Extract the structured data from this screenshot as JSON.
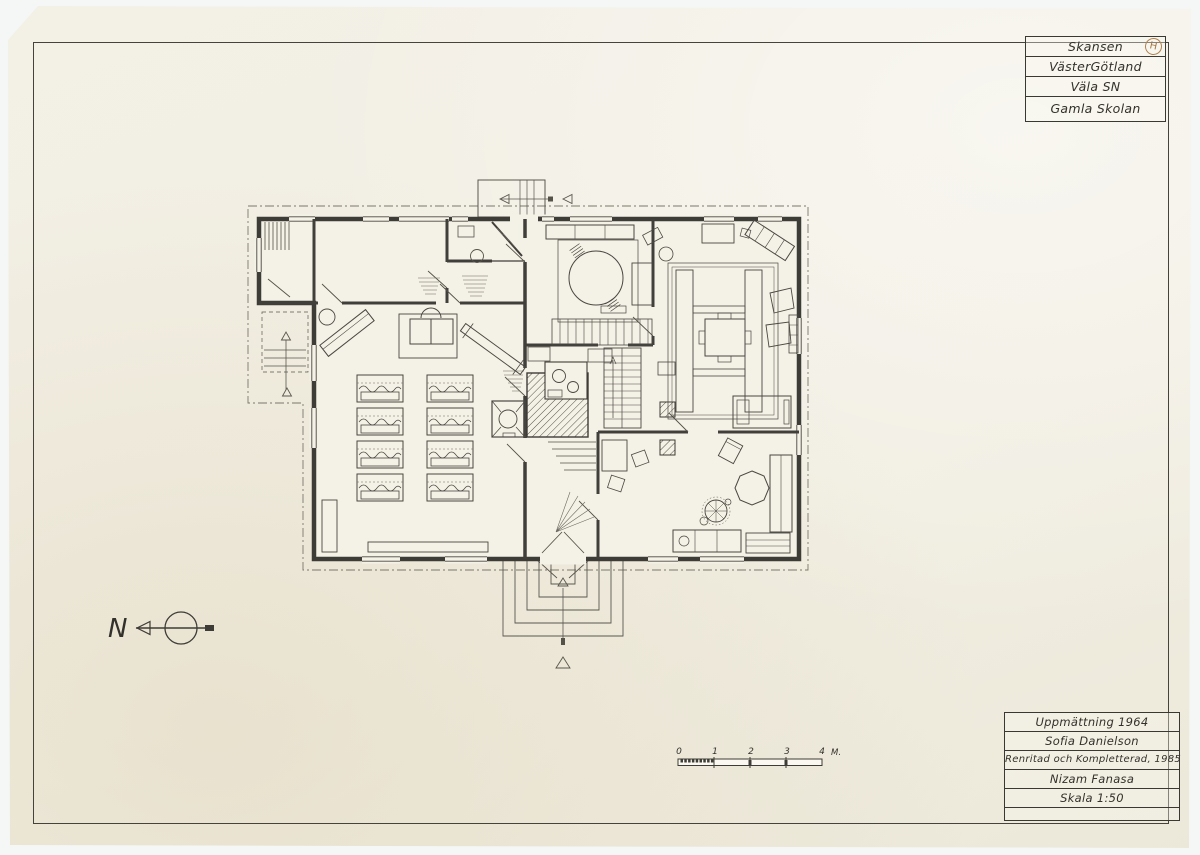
{
  "title_block": {
    "lines": [
      "Skansen",
      "VästerGötland",
      "Väla SN",
      "Gamla Skolan"
    ],
    "stamp": "H"
  },
  "info_block": {
    "lines": [
      "Uppmättning 1964",
      "Sofia Danielson",
      "Renritad och Kompletterad, 1985",
      "Nizam Fanasa",
      "Skala 1:50"
    ]
  },
  "north_arrow": {
    "label": "N"
  },
  "scale_bar": {
    "ticks": [
      "0",
      "1",
      "2",
      "3",
      "4"
    ],
    "unit": "M."
  },
  "colors": {
    "paper": "#f1eee2",
    "ink": "#3f3d37",
    "pencil": "#55524a",
    "stamp": "#b3814e",
    "backdrop": "#f4f7f6"
  }
}
